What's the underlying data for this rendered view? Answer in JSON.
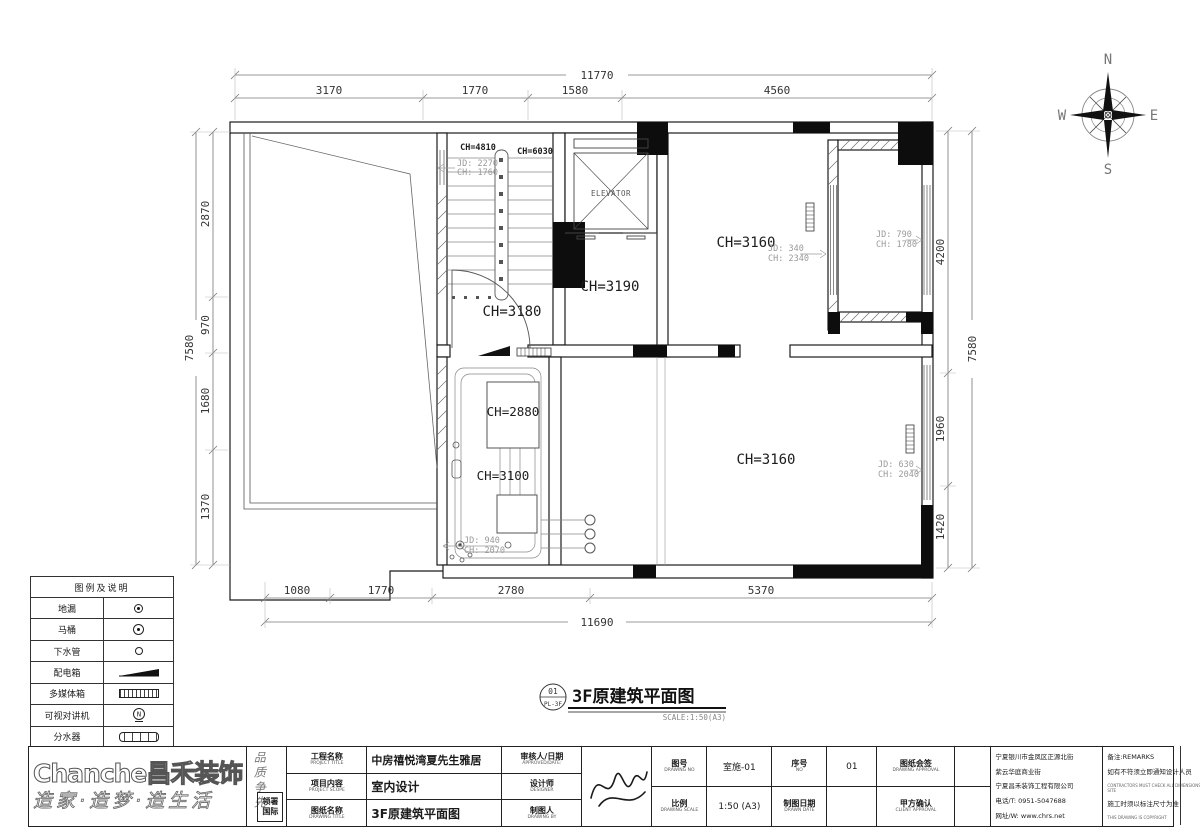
{
  "plan": {
    "stamp": {
      "num": "01",
      "code": "PL-3F",
      "title": "3F原建筑平面图",
      "scale": "SCALE:1:50(A3)"
    },
    "compass": {
      "n": "N",
      "e": "E",
      "s": "S",
      "w": "W"
    },
    "labels": {
      "stair_ch1": "CH=4810",
      "stair_ch2": "CH=6030",
      "hall": "CH=3180",
      "lobby": "CH=3190",
      "room_tr": "CH=3160",
      "room_b": "CH=3160",
      "mech_a": "CH=2880",
      "mech_b": "CH=3100",
      "elevator": "ELEVATOR"
    },
    "windows": {
      "w1_jd": "JD: 2270",
      "w1_ch": "CH: 1760",
      "w2_jd": "JD: 340",
      "w2_ch": "CH: 2340",
      "w3_jd": "JD: 790",
      "w3_ch": "CH: 1780",
      "w4_jd": "JD: 630",
      "w4_ch": "CH: 2040",
      "w5_jd": "JD: 940",
      "w5_ch": "CH: 2070"
    },
    "dims": {
      "top_total": "11770",
      "top": [
        "3170",
        "1770",
        "1580",
        "4560"
      ],
      "bottom": [
        "1080",
        "1770",
        "2780",
        "5370"
      ],
      "bottom_total": "11690",
      "left": [
        "2870",
        "970",
        "1680",
        "1370"
      ],
      "left_total": "7580",
      "right": [
        "4200",
        "1960",
        "1420"
      ],
      "right_total": "7580"
    }
  },
  "legend": {
    "title": "图例及说明",
    "items": [
      {
        "label": "地漏",
        "symbol": "floor-drain"
      },
      {
        "label": "马桶",
        "symbol": "toilet"
      },
      {
        "label": "下水管",
        "symbol": "drain-pipe"
      },
      {
        "label": "配电箱",
        "symbol": "power-box"
      },
      {
        "label": "多媒体箱",
        "symbol": "media-box"
      },
      {
        "label": "可视对讲机",
        "symbol": "intercom"
      },
      {
        "label": "分水器",
        "symbol": "manifold"
      }
    ]
  },
  "titleblock": {
    "logo": "Chanche昌禾装饰",
    "slogan": "造家·造梦·造生活",
    "side_slogan": "品质争先",
    "seal_line1": "领署",
    "seal_line2": "国际",
    "project_label": "工程名称",
    "project_label_en": "PROJECT TITLE",
    "project_value": "中房禧悦湾夏先生雅居",
    "scope_label": "项目内容",
    "scope_label_en": "PROJECT SCOPE",
    "scope_value": "室内设计",
    "drawing_label": "图纸名称",
    "drawing_label_en": "DRAWING TITLE",
    "drawing_value": "3F原建筑平面图",
    "approved_label": "审核人/日期",
    "approved_label_en": "APPROVED/DATE:",
    "designer_label": "设计师",
    "designer_label_en": "DESIGNER",
    "drawnby_label": "制图人",
    "drawnby_label_en": "DRAWING BY",
    "no_label": "图号",
    "no_label_en": "DRAWING NO",
    "no_value": "室施-01",
    "seq_label": "序号",
    "seq_label_en": "NO",
    "seq_value": "01",
    "approval_label": "图纸会签",
    "approval_label_en": "DRAWING APPROVAL",
    "scale_label": "比例",
    "scale_label_en": "DRAWING SCALE",
    "scale_value": "1:50 (A3)",
    "date_label": "制图日期",
    "date_label_en": "DRAWN DATE",
    "client_label": "甲方确认",
    "client_label_en": "CLIENT APPROVAL",
    "address1": "宁夏银川市金凤区正源北街",
    "address2": "紫云华庭商业街",
    "address3": "宁夏昌禾装饰工程有限公司",
    "phone": "电话/T: 0951-5047688",
    "web": "网址/W: www.chrs.net",
    "remark_title": "备注:REMARKS",
    "remark1": "如有不符须立即通知设计人员",
    "remark1_en": "CONTRACTORS MUST CHECK ALL DIMENSIONS ON SITE",
    "remark2": "施工时须以标注尺寸为准",
    "remark2_en": "THIS DRAWING IS COPYRIGHT"
  }
}
